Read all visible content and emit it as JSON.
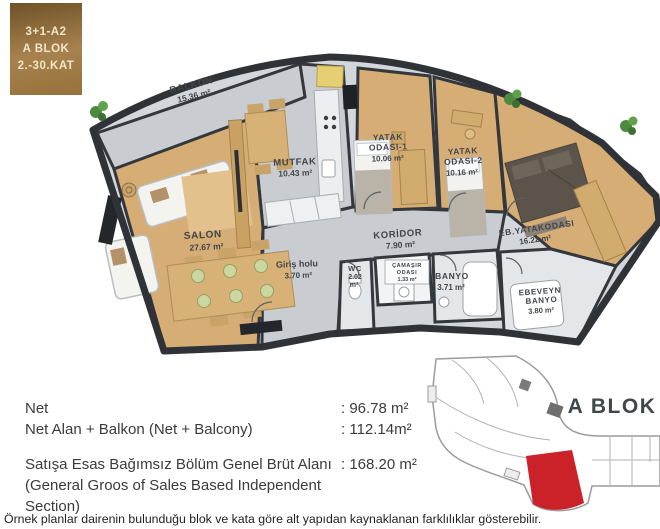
{
  "badge": {
    "model": "3+1-A2",
    "block": "A BLOK",
    "floors": "2.-30.KAT"
  },
  "floorplan": {
    "rooms": {
      "balkon": {
        "line1": "BALKON",
        "area": "15.36 m²"
      },
      "salon": {
        "line1": "SALON",
        "area": "27.67 m²"
      },
      "mutfak": {
        "line1": "MUTFAK",
        "area": "10.43 m²"
      },
      "yatak1": {
        "line1": "YATAK",
        "line2": "ODASI-1",
        "area": "10.06 m²"
      },
      "yatak2": {
        "line1": "YATAK",
        "line2": "ODASI-2",
        "area": "10.16 m²"
      },
      "ebyatak": {
        "line1": "EB.YATAKODASI",
        "area": "16.22 m²"
      },
      "koridor": {
        "line1": "KORİDOR",
        "area": "7.90 m²"
      },
      "giris": {
        "line1": "Giriş holu",
        "area": "3.70 m²"
      },
      "wc": {
        "line1": "WC",
        "line2": "2.02",
        "line3": "m²"
      },
      "camasir": {
        "line1": "ÇAMAŞIR",
        "line2": "ODASI",
        "area": "1.33 m²"
      },
      "banyo": {
        "line1": "BANYO",
        "area": "3.71 m²"
      },
      "ebbanyo": {
        "line1": "EBEVEYN",
        "line2": "BANYO",
        "area": "3.80 m²"
      }
    }
  },
  "summary": {
    "net_label": "Net",
    "net_value": ": 96.78 m²",
    "net_balcony_label": "Net Alan + Balkon (Net + Balcony)",
    "net_balcony_value": ": 112.14m²",
    "gross_label": "Satışa Esas Bağımsız Bölüm Genel Brüt Alanı",
    "gross_value": ": 168.20 m²",
    "gross_sub_label": "(General Groos of Sales Based Independent Section)"
  },
  "keyplan": {
    "block_label": "A BLOK",
    "highlight_color": "#cb2128"
  },
  "disclaimer": "Örnek planlar dairenin bulunduğu blok ve kata göre alt yapıdan kaynaklanan farklılıklar gösterebilir.",
  "colors": {
    "wall": "#34383d",
    "wood_floor": "#d6ad74",
    "gray_floor": "#c9cdd2",
    "tile_floor": "#e4e7ea",
    "badge_gold": "#a8824e",
    "highlight_red": "#cb2128"
  }
}
